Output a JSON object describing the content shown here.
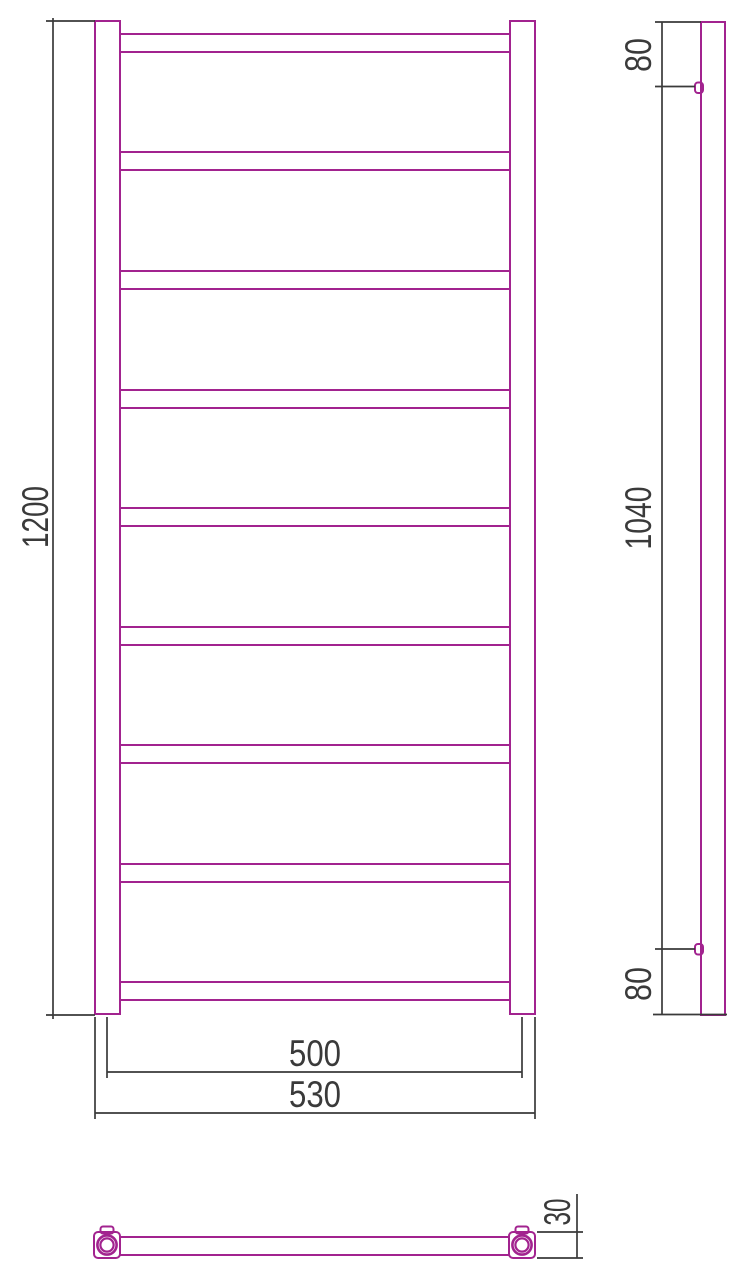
{
  "drawing": {
    "colors": {
      "outline": "#a2238f",
      "dimension": "#3a3a3a"
    },
    "views": {
      "front": {
        "crossbar_count": 9,
        "dimensions": {
          "height": "1200",
          "rail_center_width": "500",
          "overall_width": "530"
        }
      },
      "side": {
        "dimensions": {
          "top_offset": "80",
          "connector_span": "1040",
          "bottom_offset": "80"
        }
      },
      "bottom": {
        "dimensions": {
          "depth": "30"
        }
      }
    }
  }
}
